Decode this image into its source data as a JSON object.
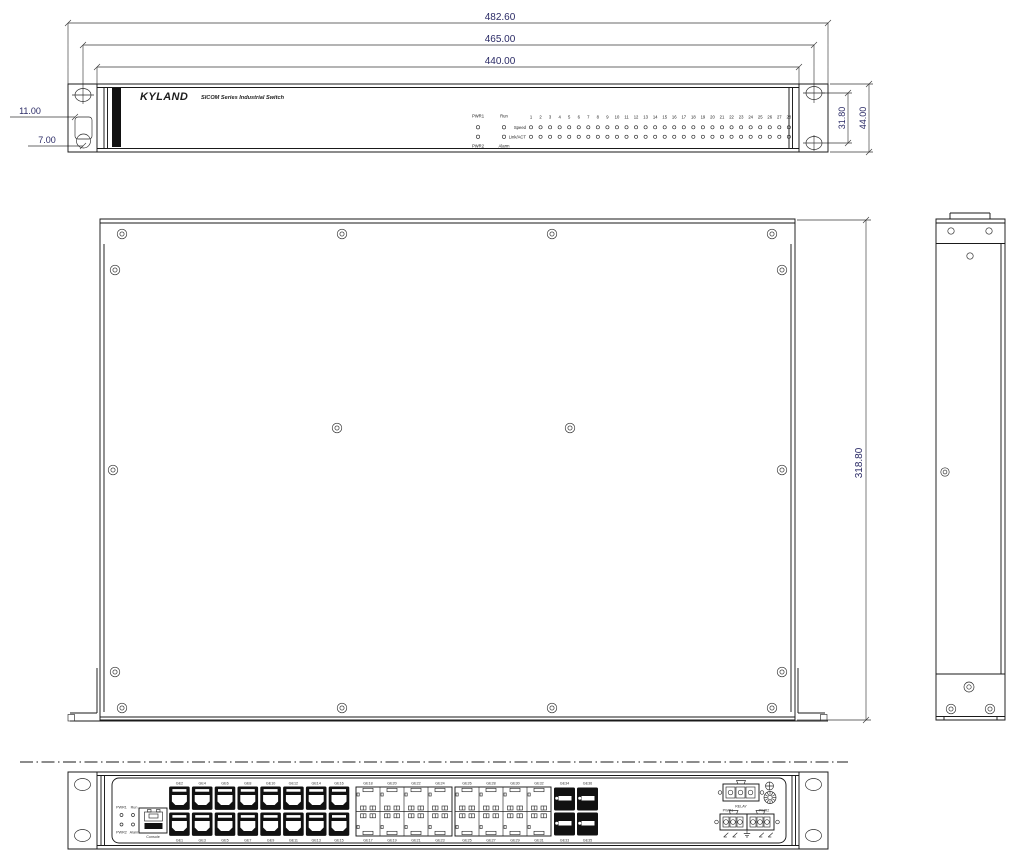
{
  "front_view": {
    "brand": "KYLAND",
    "subtitle": "SICOM Series Industrial Switch",
    "dimensions": {
      "outer_width": "482.60",
      "hole_span": "465.00",
      "body_width": "440.00",
      "ear_cutout_top": "11.00",
      "ear_cutout_bottom": "7.00",
      "ear_hole_spacing": "31.80",
      "panel_height": "44.00"
    },
    "leds": {
      "pwr1": "PWR1",
      "run": "Run",
      "pwr2": "PWR2",
      "alarm": "Alarm",
      "speed": "Speed",
      "linkact": "Link/ACT",
      "port_numbers": [
        "1",
        "2",
        "3",
        "4",
        "5",
        "6",
        "7",
        "8",
        "9",
        "10",
        "11",
        "12",
        "13",
        "14",
        "15",
        "16",
        "17",
        "18",
        "19",
        "20",
        "21",
        "22",
        "23",
        "24",
        "25",
        "26",
        "27",
        "28"
      ]
    }
  },
  "top_view": {
    "dimensions": {
      "depth": "318.80"
    }
  },
  "bottom_view": {
    "status": {
      "pwr1": "PWR1",
      "run": "Run",
      "pwr2": "PWR2",
      "alarm": "Alarm"
    },
    "console_label": "Console",
    "rj45_top": [
      "GE2",
      "GE4",
      "GE6",
      "GE8",
      "GE10",
      "GE12",
      "GE14",
      "GE16"
    ],
    "rj45_bottom": [
      "GE1",
      "GE3",
      "GE5",
      "GE7",
      "GE9",
      "GE11",
      "GE13",
      "GE15"
    ],
    "sfp1_top": [
      "GE18",
      "GE20",
      "GE22",
      "GE24"
    ],
    "sfp1_bottom": [
      "GE17",
      "GE19",
      "GE21",
      "GE23"
    ],
    "sfp2_top": [
      "GE26",
      "GE28",
      "GE30",
      "GE32"
    ],
    "sfp2_bottom": [
      "GE25",
      "GE27",
      "GE29",
      "GE31"
    ],
    "sfpx_top": [
      "GE34",
      "GE36"
    ],
    "sfpx_bottom": [
      "GE33",
      "GE35"
    ],
    "power": {
      "relay": "RELAY",
      "pwr1": "PWR1",
      "pwr2": "PWR2",
      "pin_symbols": [
        "plus",
        "minus",
        "ground",
        "plus",
        "minus"
      ]
    }
  }
}
